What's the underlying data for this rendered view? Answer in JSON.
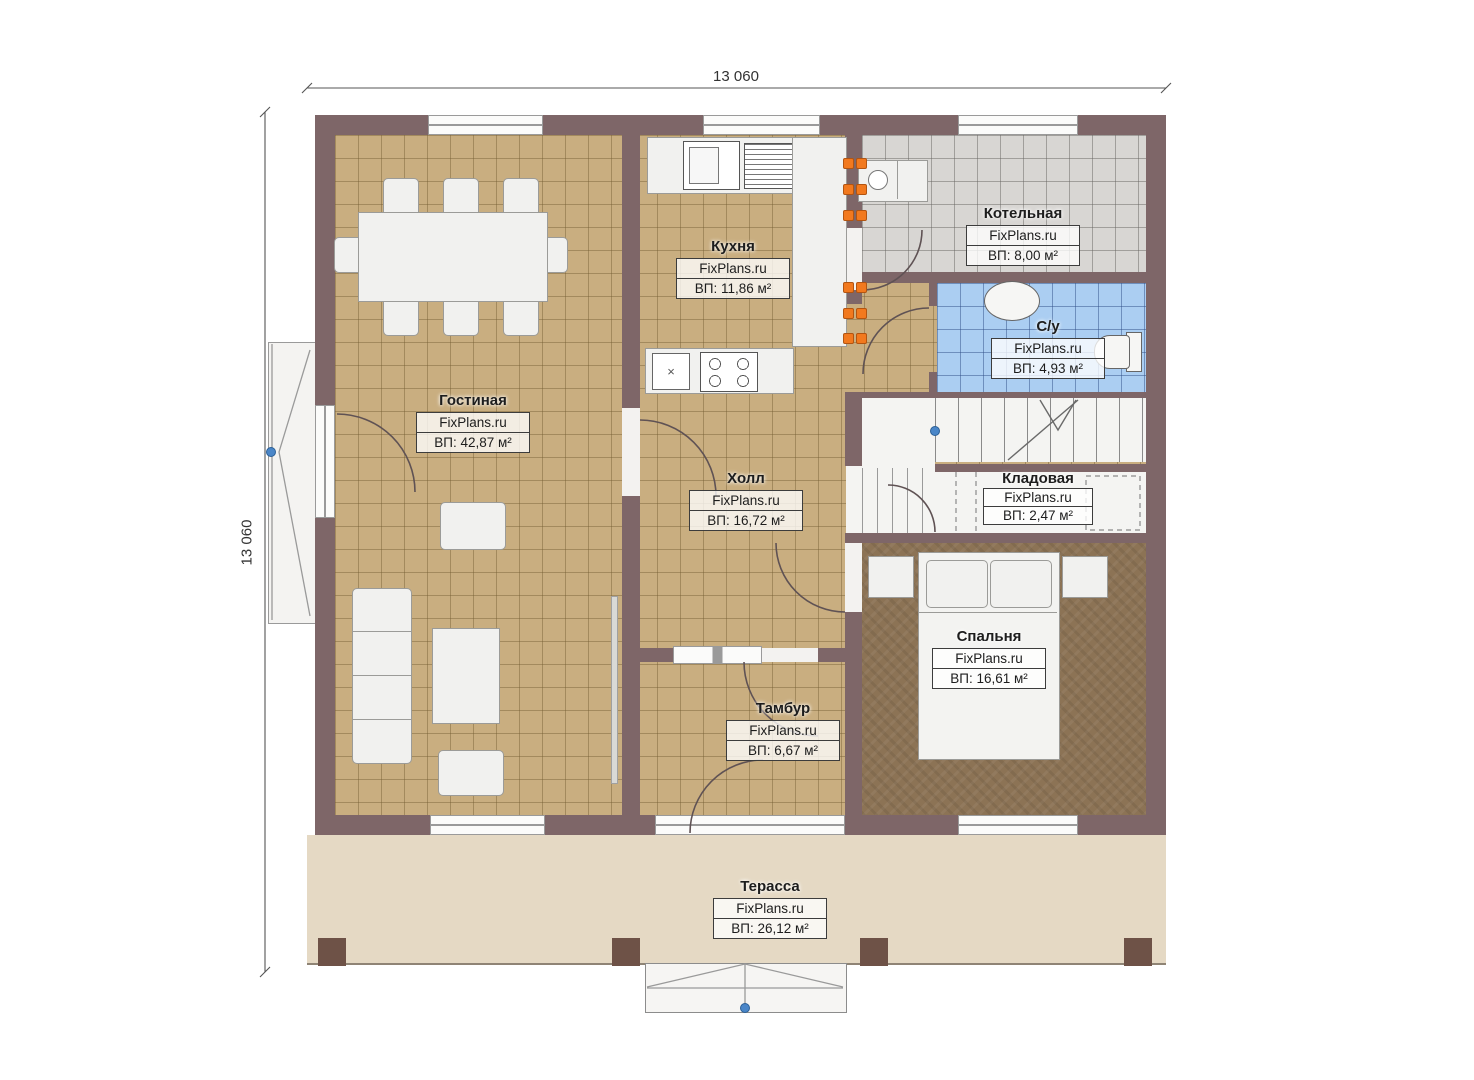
{
  "dimensions": {
    "top": "13 060",
    "left": "13 060"
  },
  "rooms": {
    "kitchen": {
      "name": "Кухня",
      "brand": "FixPlans.ru",
      "area": "ВП: 11,86 м²"
    },
    "boiler": {
      "name": "Котельная",
      "brand": "FixPlans.ru",
      "area": "ВП: 8,00 м²"
    },
    "bathroom": {
      "name": "С/у",
      "brand": "FixPlans.ru",
      "area": "ВП: 4,93 м²"
    },
    "living": {
      "name": "Гостиная",
      "brand": "FixPlans.ru",
      "area": "ВП: 42,87 м²"
    },
    "hall": {
      "name": "Холл",
      "brand": "FixPlans.ru",
      "area": "ВП: 16,72 м²"
    },
    "storage": {
      "name": "Кладовая",
      "brand": "FixPlans.ru",
      "area": "ВП: 2,47 м²"
    },
    "bedroom": {
      "name": "Спальня",
      "brand": "FixPlans.ru",
      "area": "ВП: 16,61 м²"
    },
    "vestibule": {
      "name": "Тамбур",
      "brand": "FixPlans.ru",
      "area": "ВП: 6,67 м²"
    },
    "terrace": {
      "name": "Терасса",
      "brand": "FixPlans.ru",
      "area": "ВП: 26,12 м²"
    }
  },
  "colors": {
    "wall": "#7e6668",
    "floor_tan": "#c9ae80",
    "floor_grey": "#d8d6d3",
    "floor_blue": "#abcef2",
    "floor_bedroom": "#8c7355",
    "terrace": "#e5d9c4",
    "marker_orange": "#f2791e",
    "node_blue": "#4a86c8"
  }
}
